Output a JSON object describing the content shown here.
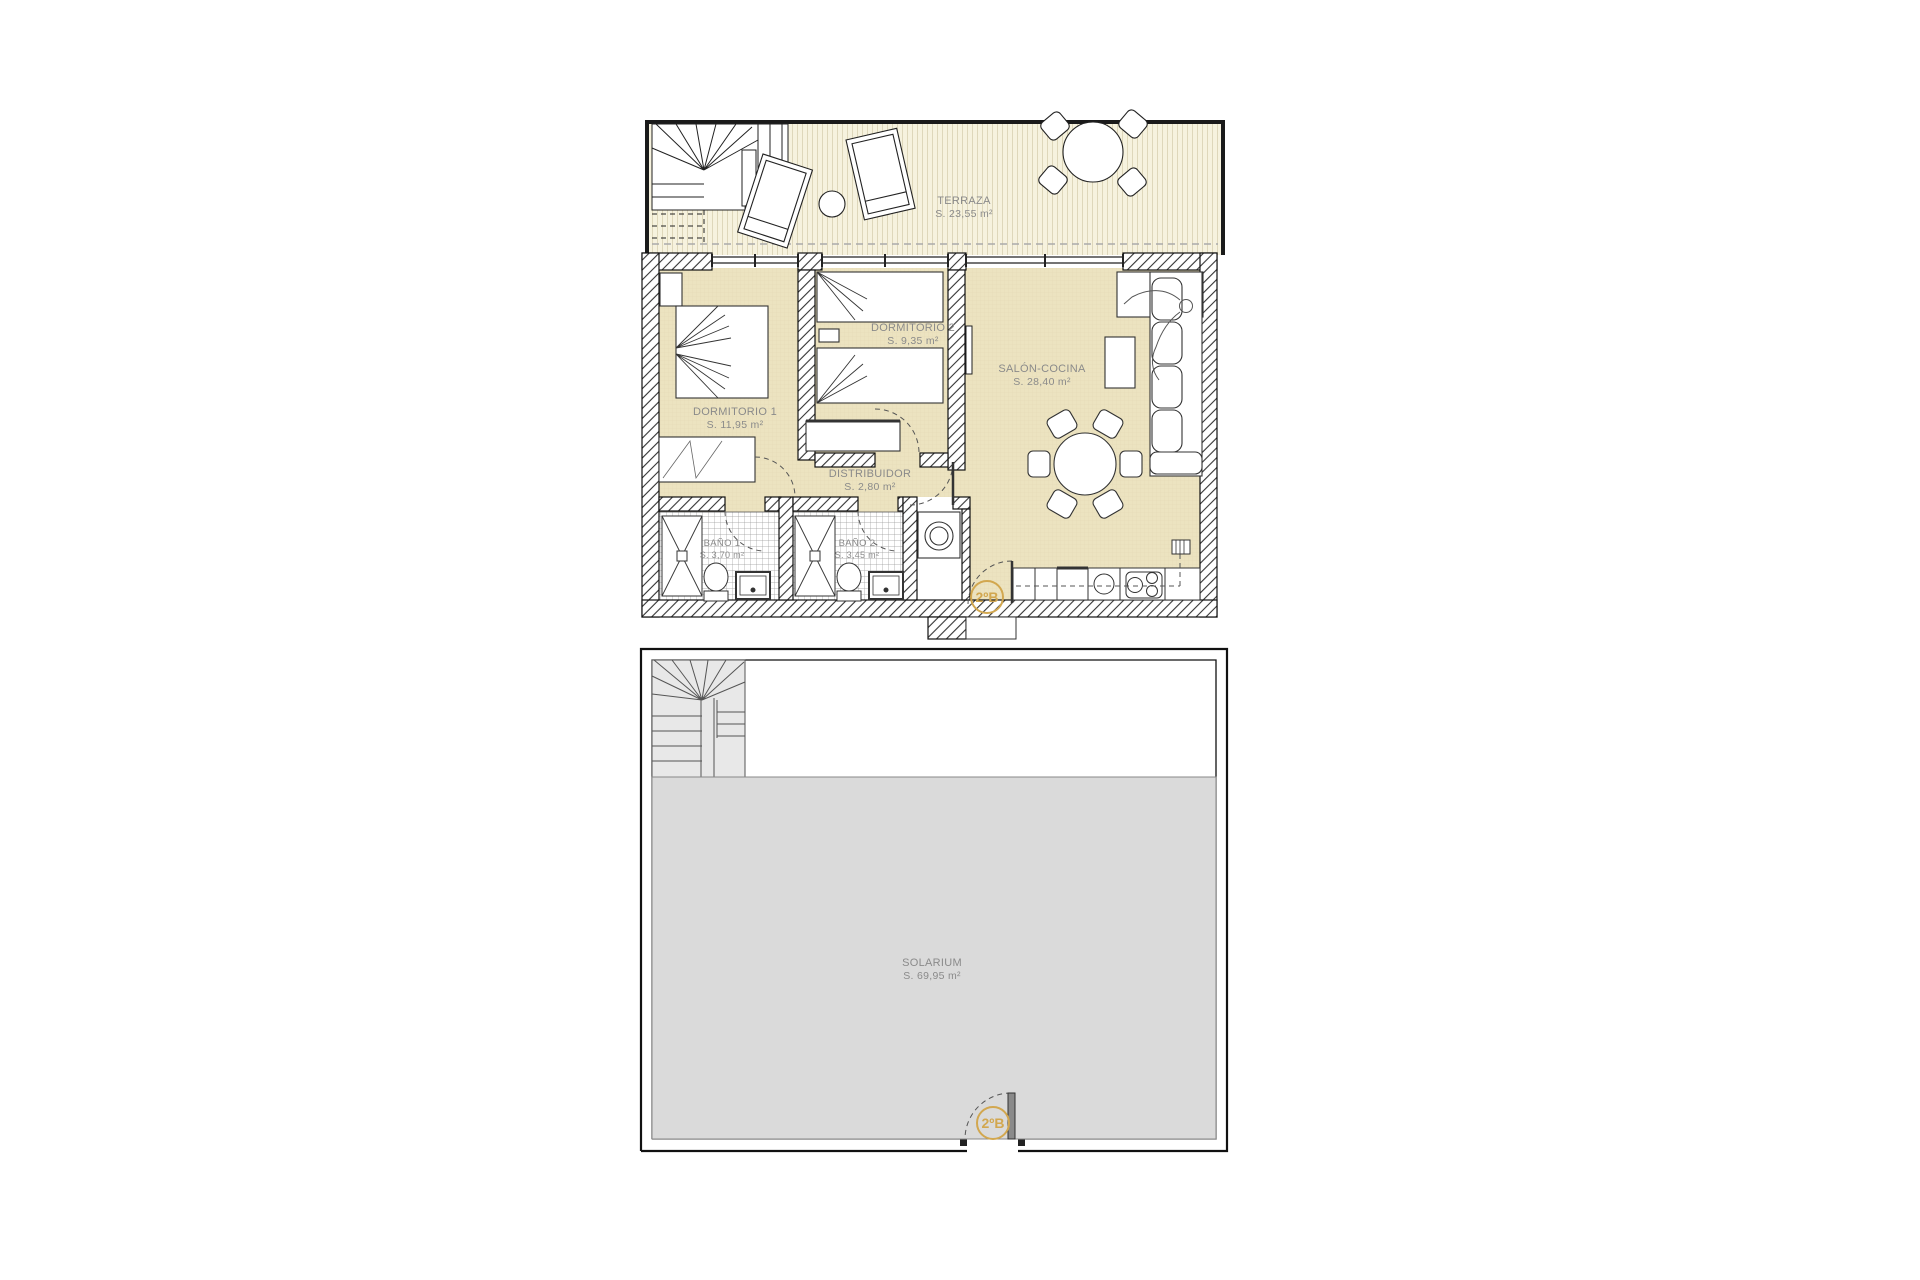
{
  "plans": {
    "upper": {
      "name": "apartment-floor",
      "unit_label": "2ºB",
      "rooms": [
        {
          "name": "TERRAZA",
          "area": "S. 23,55 m²"
        },
        {
          "name": "DORMITORIO 1",
          "area": "S. 11,95 m²"
        },
        {
          "name": "DORMITORIO 2",
          "area": "S. 9,35 m²"
        },
        {
          "name": "SALÓN-COCINA",
          "area": "S. 28,40 m²"
        },
        {
          "name": "DISTRIBUIDOR",
          "area": "S. 2,80 m²"
        },
        {
          "name": "BAÑO 1",
          "area": "S. 3,70 m²"
        },
        {
          "name": "BAÑO 2",
          "area": "S. 3,45 m²"
        }
      ]
    },
    "lower": {
      "name": "solarium-floor",
      "unit_label": "2ºB",
      "rooms": [
        {
          "name": "SOLARIUM",
          "area": "S. 69,95 m²"
        }
      ]
    }
  },
  "colors": {
    "room_fill": "#ece3c0",
    "terrace_fill": "#f6f2de",
    "solarium_fill": "#dadada",
    "badge_accent": "#d2a74f",
    "label_text": "#8a8a8a",
    "wall_line": "#111111"
  }
}
